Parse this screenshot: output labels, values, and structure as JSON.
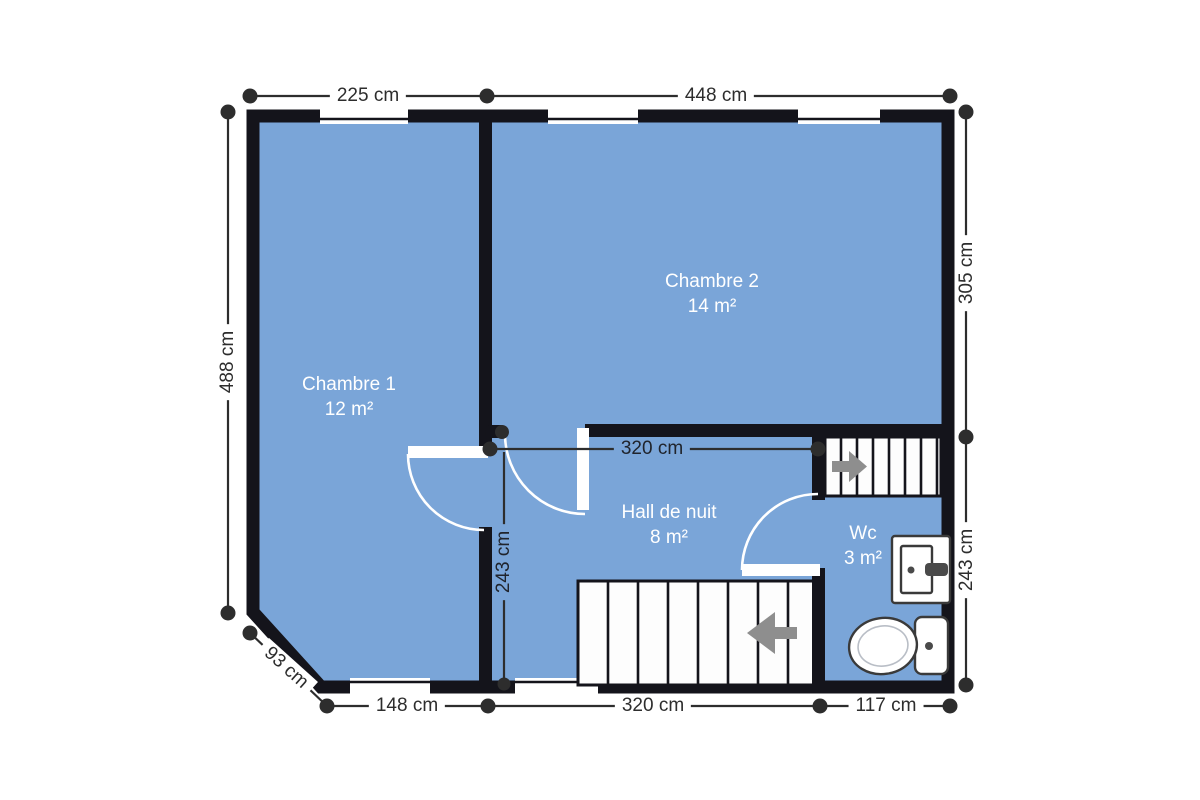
{
  "plan": {
    "title": "floor-plan",
    "rooms": [
      {
        "id": "chambre1",
        "name": "Chambre 1",
        "area": "12 m²"
      },
      {
        "id": "chambre2",
        "name": "Chambre 2",
        "area": "14 m²"
      },
      {
        "id": "hall",
        "name": "Hall de nuit",
        "area": "8 m²"
      },
      {
        "id": "wc",
        "name": "Wc",
        "area": "3 m²"
      }
    ],
    "dimensions": {
      "top_left": "225 cm",
      "top_right": "448 cm",
      "left": "488 cm",
      "right_top": "305 cm",
      "right_bottom": "243 cm",
      "bottom_left": "148 cm",
      "bottom_middle": "320 cm",
      "bottom_right": "117 cm",
      "diagonal": "93 cm",
      "interior_horizontal": "320 cm",
      "interior_vertical": "243 cm"
    },
    "icons": {
      "stairs_up_arrow": "right-arrow",
      "stairs_down_arrow": "left-arrow",
      "toilet": "toilet-icon",
      "sink": "sink-icon"
    },
    "colors": {
      "floor": "#7aa5d8",
      "wall": "#14141b",
      "dim": "#2d2d2d",
      "roomtext": "#ffffff",
      "arrow": "#8e8e8e",
      "fixture": "#3a3a3a"
    }
  }
}
